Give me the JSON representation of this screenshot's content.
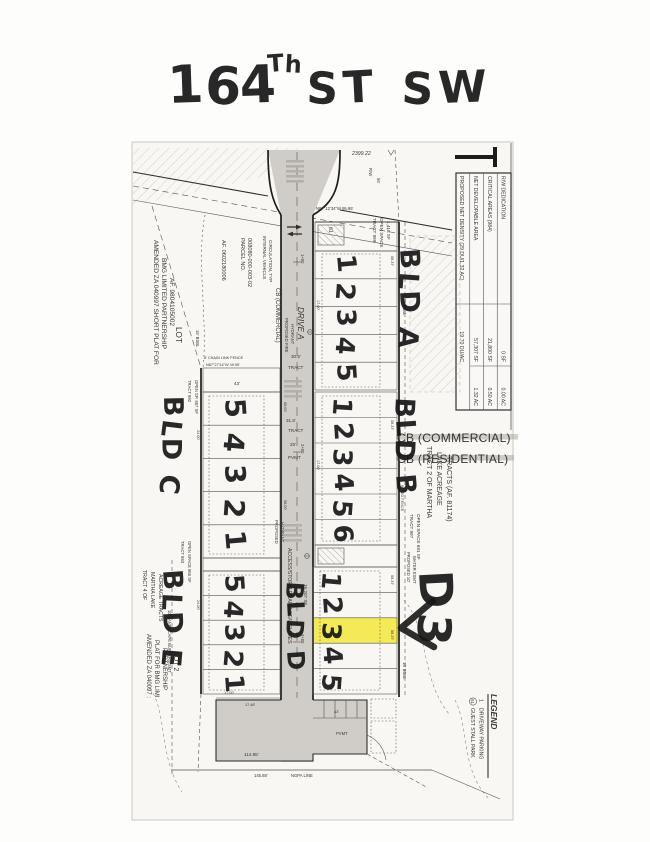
{
  "title": {
    "number": "164",
    "ordinal": "Th",
    "street": "ST SW"
  },
  "annotations": {
    "bld_a": "BLD A",
    "bld_b": "BLD B",
    "bld_c": "BLD C",
    "bld_d": "BLD D",
    "bld_e": "BLD E",
    "callout": "D3",
    "units_a": [
      "1",
      "2",
      "3",
      "4",
      "5"
    ],
    "units_b": [
      "1",
      "2",
      "3",
      "4",
      "5",
      "6"
    ],
    "units_c": [
      "5",
      "4",
      "3",
      "2",
      "1"
    ],
    "units_d": [
      "1",
      "2",
      "3",
      "4",
      "5"
    ],
    "units_e": [
      "5",
      "4",
      "3",
      "2",
      "1"
    ],
    "highlight_color": "#f3e63a"
  },
  "summary_table": {
    "rows": [
      {
        "label": "R/W DEDICATION",
        "area": "0 SF",
        "acres": "0.00 AC"
      },
      {
        "label": "CRITICAL AREAS (984)",
        "area": "21,800 SF",
        "acres": "0.50 AC"
      },
      {
        "label": "NET DEVELOPABLE AREA",
        "area": "57,307 SF",
        "acres": "1.32 AC"
      },
      {
        "label": "PROPOSED NET DENSITY (29 DU/1.32 AC)",
        "area": "19.70 DU/AC",
        "acres": ""
      }
    ]
  },
  "legend": {
    "title": "LEGEND",
    "items": [
      {
        "symbol": "1",
        "label": "DRIVEWAY PARKING"
      },
      {
        "symbol": "61",
        "label": "GUEST STALL PARK"
      }
    ]
  },
  "map_labels": {
    "drive_a": "DRIVE A",
    "cb_commercial": "CB (COMMERCIAL)",
    "cb_residential": "CB (RESIDENTIAL)",
    "parcel_1": "PARCEL NO.",
    "parcel_2": "008080-000-003-02",
    "af_top": "AF. 0602180006",
    "internal_1": "INTERNAL VEHICLE",
    "internal_2": "CIRCULATION, TYP",
    "fire_1": "PROPOSED FIRE",
    "fire_2": "HYDRANT",
    "prop_1": "PROPOSED",
    "lot": "LOT",
    "lot_2": "LOT 2",
    "amended_top_1": "AMENDED ZA 040997 SHORT PLAT FOR",
    "amended_top_2": "BMG LIMITED PARTNERSHIP",
    "amended_top_3": "AF. 9804105002",
    "amended_bot_1": "AMENDED ZA 040097 :",
    "amended_bot_2": "PLAT FOR BMG LIMI",
    "amended_bot_3": "PARTNERSHIP",
    "t999_1": "TRACT 999",
    "t999_2": "OPEN SPACE",
    "t999_3": "1,418 SF",
    "t997_1": "TRACT 997",
    "t997_2": "OPEN SPACE  691 SF",
    "t992_1": "TRACT 992",
    "t992_2": "OPEN SP.  957 SF",
    "t993_1": "TRACT 993",
    "t993_2": "OPEN SPACE  865 SF",
    "t2_1": "TRACT 2 OF MARTHA",
    "t2_2": "LAKE ACREAGE",
    "t2_3": "TRACTS (AF. 81174)",
    "t4_1": "TRACT 4 OF",
    "t4_2": "MARTHA LAKE",
    "t4_3": "ACREAGE TRACTS",
    "access": "ACCESS/STORM DRAINAGE/UTILITIES",
    "access_sf": "16,207 SF",
    "water_1": "PROPOSED 10'",
    "water_2": "WATER ESMT",
    "buffer": "10' LANDSCAPE BUFFER/ESMT",
    "bsbl": "15' BSBL",
    "chain_fence": "8' CHAIN LINK FENCE",
    "wood_fence": "WOOD FENCE",
    "bearing_top": "N87°12'34\"W  95.95'",
    "bearing_c": "N87°27'14\"W  49.95'",
    "dim_2399": "2399.22",
    "rw": "R/W",
    "d56": "56'",
    "ex_pvmt": "EX PVMT",
    "d293": "29.3'",
    "tract": "TRACT",
    "pvmt": "PVMT",
    "d305": "30.5'",
    "d315": "31.5'",
    "d25": "25'",
    "d43": "43'",
    "st1": "1+00",
    "st2": "2+00",
    "st3": "3+00",
    "stall61": "61",
    "d5837": "58.37'",
    "d5800": "58.00'",
    "d2400": "24.00'",
    "d1700": "17.00'",
    "d1748": "17.48'",
    "d11485": "114.85'",
    "d14588": "145.88'",
    "ngpa": "NGPA LINE"
  }
}
